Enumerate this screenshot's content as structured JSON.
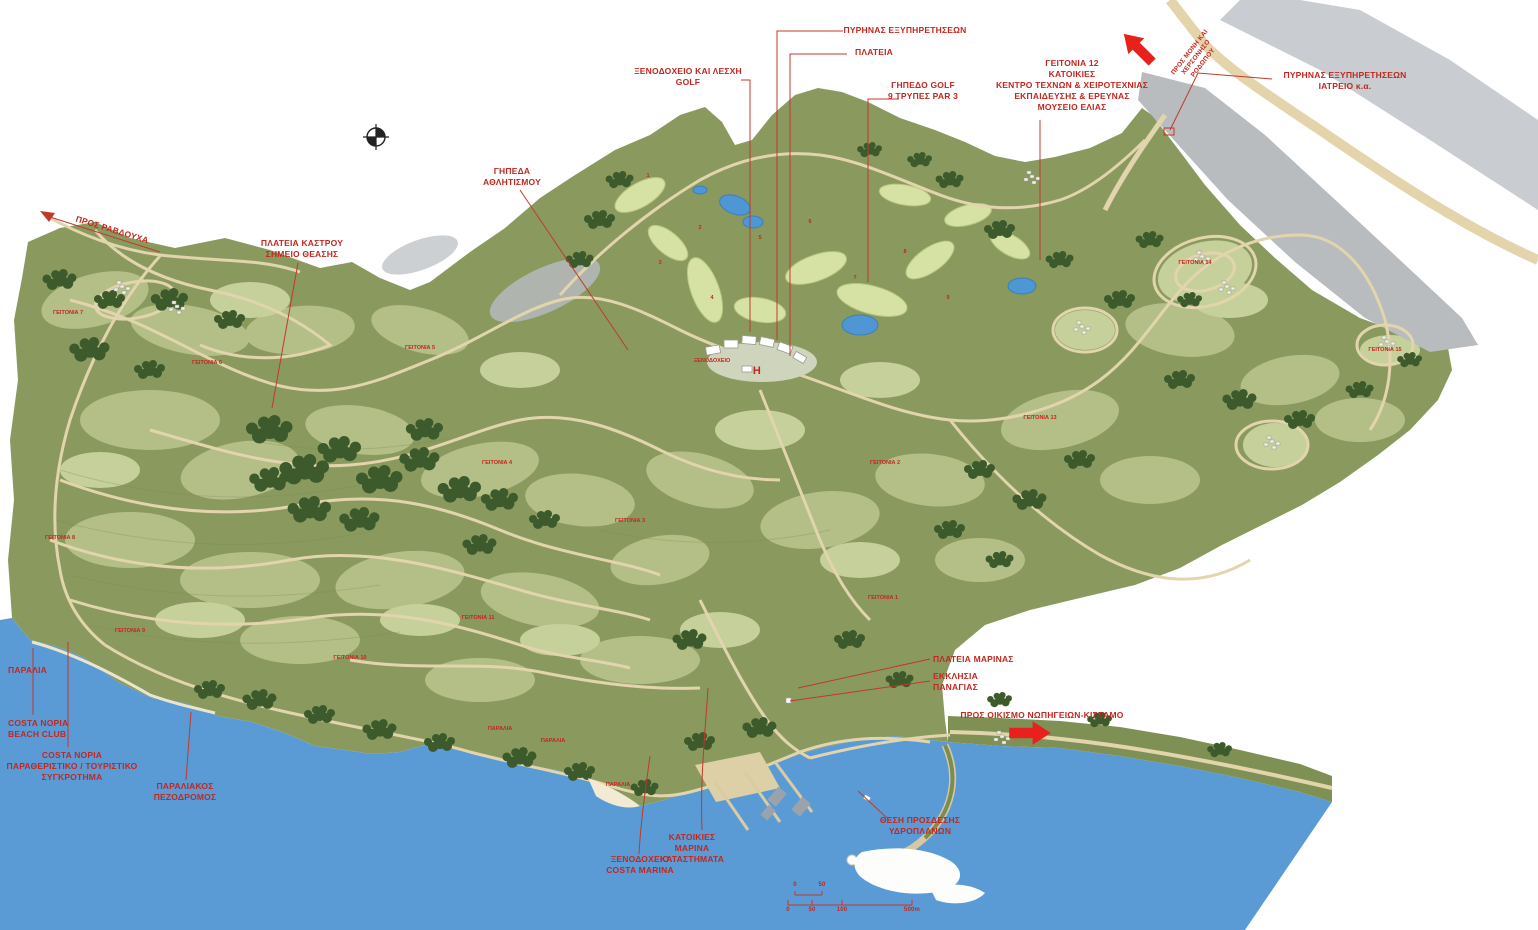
{
  "map": {
    "type": "site-masterplan",
    "colors": {
      "sea": "#5b9bd5",
      "land": "#8a9a5f",
      "parcel_light": "#b6c189",
      "golf": "#d6e2a4",
      "road": "#e2d4ac",
      "tree": "#3c5a2b",
      "rock_grey": "#b8bcbf",
      "annotation_red": "#c2271f",
      "arrow_red": "#e8211d"
    },
    "labels": {
      "pros_ravdoucha": "ΠΡΟΣ ΡΑΒΔΟΥΧΑ",
      "plateia_kastrou": "ΠΛΑΤΕΙΑ ΚΑΣΤΡΟΥ\nΣΗΜΕΙΟ ΘΕΑΣΗΣ",
      "gipeda_athlitismou": "ΓΗΠΕΔΑ\nΑΘΛΗΤΙΣΜΟΥ",
      "xenodoxeio_lesxi_golf": "ΞΕΝΟΔΟΧΕΙΟ ΚΑΙ ΛΕΣΧΗ\nGOLF",
      "pyrinas_exypiretiseon": "ΠΥΡΗΝΑΣ ΕΞΥΠΗΡΕΤΗΣΕΩΝ",
      "plateia": "ΠΛΑΤΕΙΑ",
      "gipedo_golf_9": "ΓΗΠΕΔΟ GOLF\n9 ΤΡΥΠΕΣ PAR 3",
      "geitonia_12_block": "ΓΕΙΤΟΝΙΑ 12\nΚΑΤΟΙΚΙΕΣ\nΚΕΝΤΡΟ ΤΕΧΝΩΝ & ΧΕΙΡΟΤΕΧΝΙΑΣ\nΕΚΠΑΙΔΕΥΣΗΣ & ΕΡΕΥΝΑΣ\nΜΟΥΣΕΙΟ ΕΛΙΑΣ",
      "pyrinas_iatreio": "ΠΥΡΗΝΑΣ ΕΞΥΠΗΡΕΤΗΣΕΩΝ\nΙΑΤΡΕΙΟ κ.α.",
      "pros_moni": "ΠΡΟΣ ΜΟΝΗ ΚΑΙ\nΧΕΡΣΟΝΗΣΟ\nΡΟΔΩΠΟΥ",
      "plateia_marinas": "ΠΛΑΤΕΙΑ ΜΑΡΙΝΑΣ",
      "ekklisia_panagias": "ΕΚΚΛΗΣΙΑ\nΠΑΝΑΓΙΑΣ",
      "pros_oikismo": "ΠΡΟΣ ΟΙΚΙΣΜΟ ΝΩΠΗΓΕΙΩΝ-ΚΙΣΣΑΜΟ",
      "thesi_prosdesis": "ΘΕΣΗ ΠΡΟΣΔΕΣΗΣ\nΥΔΡΟΠΛΑΝΩΝ",
      "katoikies_marina": "ΚΑΤΟΙΚΙΕΣ\nΜΑΡΙΝΑ\nΚΑΤΑΣΤΗΜΑΤΑ",
      "xenodoxeio_costa_marina": "ΞΕΝΟΔΟΧΕΙΟ\nCOSTA MARINA",
      "paralia": "ΠΑΡΑΛΙΑ",
      "costa_beach_club": "COSTA NOPIA\nBEACH CLUB",
      "costa_sygkrotima": "COSTA NOPIA\nΠΑΡΑΘΕΡΙΣΤΙΚΟ / ΤΟΥΡΙΣΤΙΚΟ\nΣΥΓΚΡΟΤΗΜΑ",
      "paraliakos_pezodromos": "ΠΑΡΑΛΙΑΚΟΣ\nΠΕΖΟΔΡΟΜΟΣ",
      "hotel_central": "ΞΕΝΟΔΟΧΕΙΟ",
      "helipad": "H"
    },
    "neighborhoods": [
      {
        "text": "ΓΕΙΤΟΝΙΑ 7"
      },
      {
        "text": "ΓΕΙΤΟΝΙΑ 6"
      },
      {
        "text": "ΓΕΙΤΟΝΙΑ 5"
      },
      {
        "text": "ΓΕΙΤΟΝΙΑ 4"
      },
      {
        "text": "ΓΕΙΤΟΝΙΑ 3"
      },
      {
        "text": "ΓΕΙΤΟΝΙΑ 2"
      },
      {
        "text": "ΓΕΙΤΟΝΙΑ 1"
      },
      {
        "text": "ΓΕΙΤΟΝΙΑ 8"
      },
      {
        "text": "ΓΕΙΤΟΝΙΑ 9"
      },
      {
        "text": "ΓΕΙΤΟΝΙΑ 10"
      },
      {
        "text": "ΓΕΙΤΟΝΙΑ 11"
      },
      {
        "text": "ΓΕΙΤΟΝΙΑ 13"
      },
      {
        "text": "ΓΕΙΤΟΝΙΑ 14"
      },
      {
        "text": "ΓΕΙΤΟΝΙΑ 15"
      }
    ],
    "golf_holes": [
      "1",
      "2",
      "3",
      "4",
      "5",
      "6",
      "7",
      "8",
      "9"
    ],
    "scale_bar": {
      "upper": [
        "0",
        "50"
      ],
      "lower": [
        "0",
        "50",
        "100",
        "500m"
      ]
    }
  }
}
